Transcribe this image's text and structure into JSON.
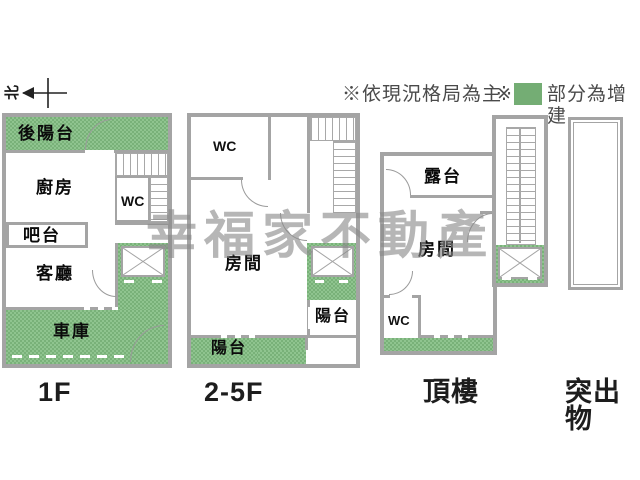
{
  "watermark": {
    "text": "幸福家不動產"
  },
  "legend": {
    "note_main": "※依現況格局為主",
    "note_mark": "※",
    "note_green": "部分為增建",
    "green_hex": "#79b179",
    "wall_hex": "#a4a4a4"
  },
  "compass": {
    "label": "北"
  },
  "floors": {
    "f1": {
      "name": "1F",
      "rooms": {
        "rear_balcony": "後陽台",
        "kitchen": "廚房",
        "wc": "WC",
        "bar": "吧台",
        "living": "客廳",
        "garage": "車庫"
      }
    },
    "f2": {
      "name": "2-5F",
      "rooms": {
        "wc": "WC",
        "room": "房間",
        "balcony_side": "陽台",
        "balcony_bottom": "陽台"
      }
    },
    "roof": {
      "name": "頂樓",
      "rooms": {
        "terrace": "露台",
        "room": "房間",
        "wc": "WC"
      }
    },
    "protrusion": {
      "name": "突出物"
    }
  }
}
